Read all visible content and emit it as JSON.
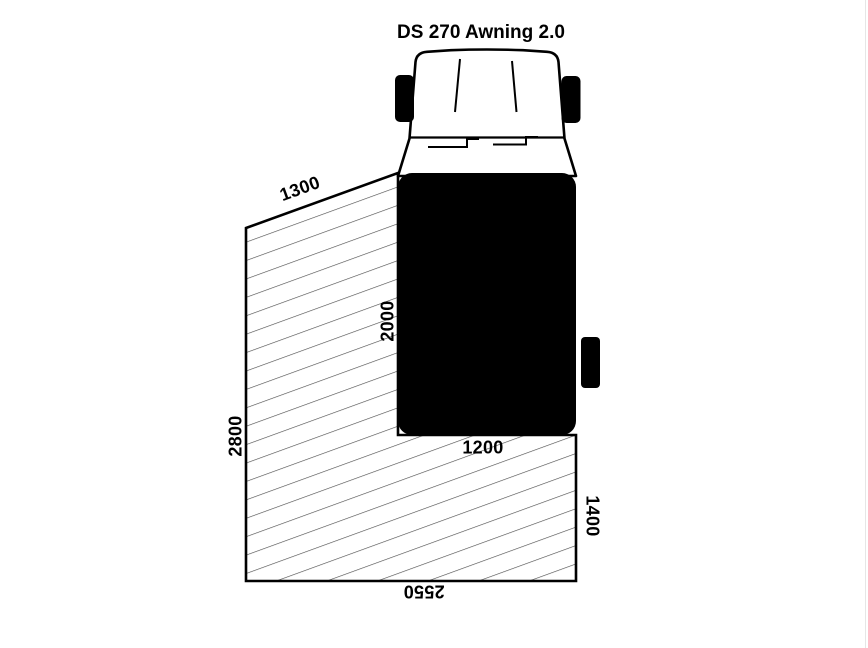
{
  "title": "DS 270 Awning 2.0",
  "dimensions": {
    "awning_front_edge": "1300",
    "vehicle_side": "2000",
    "awning_left_edge": "2800",
    "vehicle_rear": "1200",
    "awning_right_edge": "1400",
    "awning_rear_edge": "2550"
  },
  "colors": {
    "ink": "#000000",
    "hatch_line": "#4a4a4a",
    "background": "#ffffff"
  }
}
